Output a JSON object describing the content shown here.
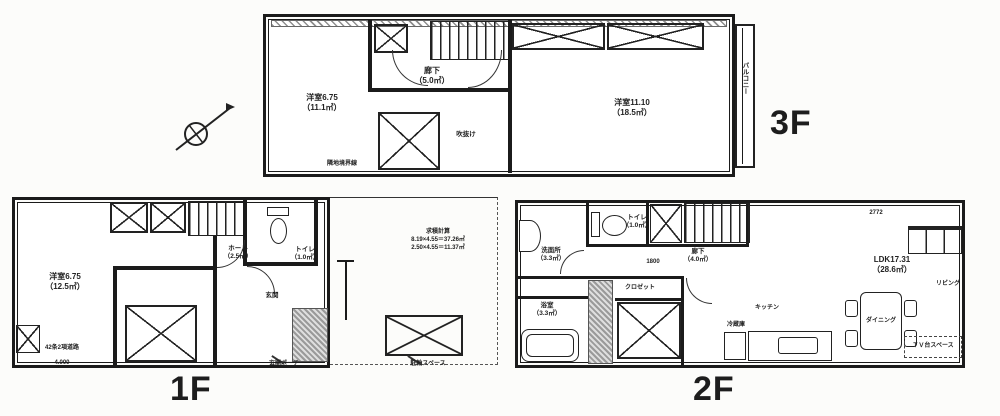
{
  "scan": {
    "background": "#fcfcfa",
    "ink": "#1b1b1b"
  },
  "floor3": {
    "floor_label": "3F",
    "room_west_name": "洋室6.75",
    "room_west_area": "（11.1㎡）",
    "hall_name": "廊下",
    "hall_area": "（5.0㎡）",
    "room_east_name": "洋室11.10",
    "room_east_area": "（18.5㎡）",
    "void_label": "吹抜け",
    "balcony_label": "バルコニー",
    "boundary_note": "隣地境界線"
  },
  "floor1": {
    "floor_label": "1F",
    "room_west_name": "洋室6.75",
    "room_west_area": "（12.5㎡）",
    "hall_name": "ホール",
    "hall_area": "（2.5㎡）",
    "toilet_name": "トイレ",
    "toilet_area": "（1.0㎡）",
    "entrance_label": "玄関",
    "calc_title": "求積計算",
    "calc_line1": "8.19×4.55＝37.26㎡",
    "calc_line2": "2.50×4.55＝11.37㎡",
    "porch_note": "玄関ポーチ",
    "parking_note": "駐輪スペース",
    "road_note": "42条2項道路",
    "road_width": "4.000"
  },
  "floor2": {
    "floor_label": "2F",
    "washroom_name": "洗面所",
    "washroom_area": "（3.3㎡）",
    "toilet_name": "トイレ",
    "toilet_area": "（1.0㎡）",
    "hall_name": "廊下",
    "hall_area": "（4.0㎡）",
    "bath_name": "浴室",
    "bath_area": "（3.3㎡）",
    "closet_label": "クロゼット",
    "ldk_name": "LDK17.31",
    "ldk_area": "（28.6㎡）",
    "living_label": "リビング",
    "dining_label": "ダイニング",
    "kitchen_label": "キッチン",
    "fridge_label": "冷蔵庫",
    "tv_note": "ＴＶ台スペース",
    "dim_a": "2772",
    "dim_b": "1800"
  }
}
